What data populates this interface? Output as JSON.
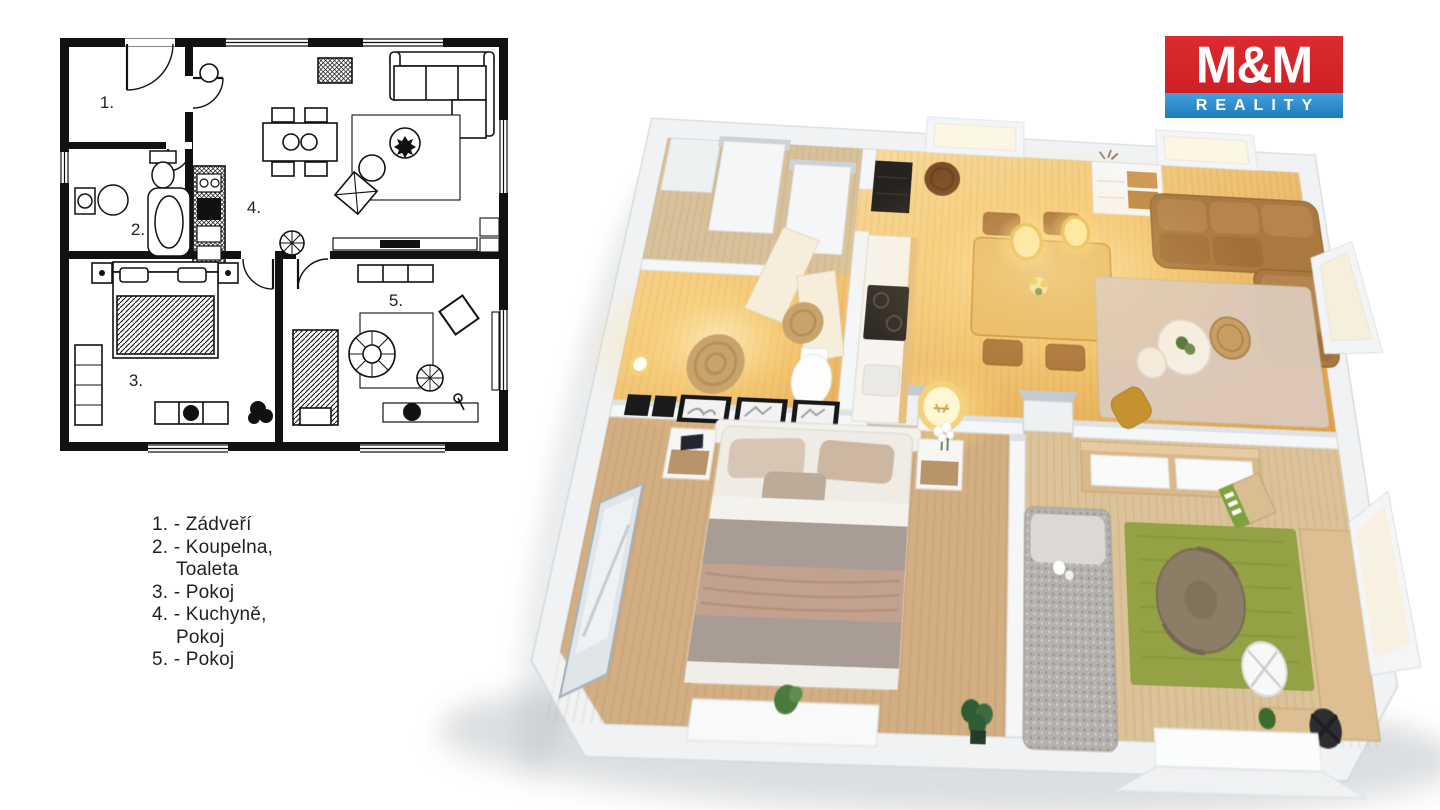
{
  "page": {
    "background": "#ffffff"
  },
  "logo": {
    "title": "M&M",
    "subtitle": "REALITY",
    "red": "#d5262c",
    "blue": "#2a8cca"
  },
  "plan2d": {
    "numbers": [
      {
        "label": "1."
      },
      {
        "label": "2."
      },
      {
        "label": "3."
      },
      {
        "label": "4."
      },
      {
        "label": "5."
      }
    ]
  },
  "legend": {
    "lines": [
      {
        "text": "1. - Zádveří",
        "indent": false
      },
      {
        "text": "2. - Koupelna,",
        "indent": false
      },
      {
        "text": "Toaleta",
        "indent": true
      },
      {
        "text": "3. - Pokoj",
        "indent": false
      },
      {
        "text": "4. - Kuchyně,",
        "indent": false
      },
      {
        "text": "Pokoj",
        "indent": true
      },
      {
        "text": "5. - Pokoj",
        "indent": false
      }
    ]
  },
  "render3d": {
    "rooms": [
      {
        "name": "entry-hall"
      },
      {
        "name": "bathroom-toilet"
      },
      {
        "name": "kitchen-living-room"
      },
      {
        "name": "bedroom"
      },
      {
        "name": "kids-room"
      }
    ],
    "furniture": [
      "wardrobe",
      "jute-rug",
      "kitchen-counter",
      "cooktop",
      "dining-table",
      "pendant-lamps",
      "corner-sofa",
      "coffee-tables",
      "area-rug",
      "floor-lantern",
      "double-bed",
      "nightstands",
      "standing-mirror",
      "sideboard",
      "single-bed",
      "green-rug",
      "bean-bag",
      "desk",
      "desk-chair",
      "office-chair"
    ],
    "colors": {
      "warm_floor": "#ecb45f",
      "entry_floor": "#d8c09b",
      "bedroom_floor": "#d3ae83",
      "kids_floor": "#dcc298",
      "wall": "#f2f4f5",
      "sofa_brown": "#aa7942",
      "rug_beige": "#dcc9b9",
      "rug_green": "#94a145",
      "glow": "#ffd97e"
    }
  }
}
